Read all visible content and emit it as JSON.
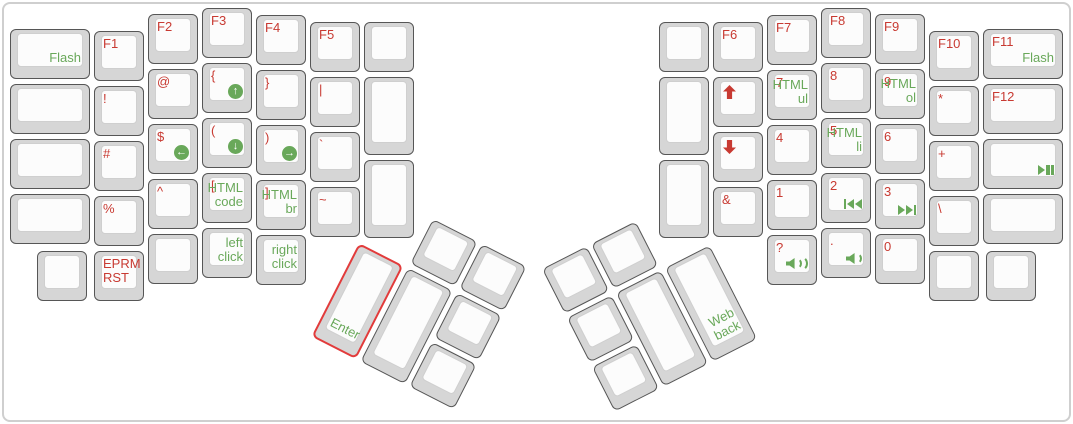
{
  "app": {
    "name": "keyboard-layout-view"
  },
  "colors": {
    "red": "#c83a32",
    "green": "#69a85a",
    "cap": "#d6d6d6",
    "ktop": "#fcfcfc",
    "kborder": "#565656",
    "ktopborder": "#cfcfcf",
    "enterline": "#e23b3b",
    "frame": "#cfcfcf"
  },
  "icons": {
    "circle-arrow-up": "↑",
    "circle-arrow-down": "↓",
    "circle-arrow-left": "←",
    "circle-arrow-right": "→"
  },
  "clusters": [
    {
      "id": "lt",
      "name": "left-thumb-cluster",
      "x": 384,
      "y": 194,
      "angle": 27
    },
    {
      "id": "rt",
      "name": "right-thumb-cluster",
      "x": 542,
      "y": 269,
      "angle": -27
    }
  ],
  "keys": [
    {
      "n": "flash",
      "x": 10,
      "y": 29,
      "w": 80,
      "br": "Flash"
    },
    {
      "n": "blank-l0r1",
      "x": 10,
      "y": 84,
      "w": 80
    },
    {
      "n": "blank-l0r2",
      "x": 10,
      "y": 139,
      "w": 80
    },
    {
      "n": "blank-l0r3",
      "x": 10,
      "y": 194,
      "w": 80
    },
    {
      "n": "f1",
      "x": 94,
      "y": 31,
      "tl": "F1"
    },
    {
      "n": "exclamation",
      "x": 94,
      "y": 86,
      "tl": "!"
    },
    {
      "n": "hash",
      "x": 94,
      "y": 141,
      "tl": "#"
    },
    {
      "n": "percent",
      "x": 94,
      "y": 196,
      "tl": "%"
    },
    {
      "n": "eprm-rst",
      "x": 94,
      "y": 251,
      "tl": "EPRM\nRST"
    },
    {
      "n": "blank-lb0",
      "x": 37,
      "y": 251
    },
    {
      "n": "f2",
      "x": 148,
      "y": 14,
      "tl": "F2"
    },
    {
      "n": "at",
      "x": 148,
      "y": 69,
      "tl": "@"
    },
    {
      "n": "dollar-mouse-left",
      "x": 148,
      "y": 124,
      "tl": "$",
      "ic": "circle-arrow-left"
    },
    {
      "n": "caret",
      "x": 148,
      "y": 179,
      "tl": "^"
    },
    {
      "n": "blank-lb2",
      "x": 148,
      "y": 234
    },
    {
      "n": "f3",
      "x": 202,
      "y": 8,
      "tl": "F3"
    },
    {
      "n": "brace-open-mouse-up",
      "x": 202,
      "y": 63,
      "tl": "{",
      "ic": "circle-arrow-up"
    },
    {
      "n": "paren-open-mouse-down",
      "x": 202,
      "y": 118,
      "tl": "(",
      "ic": "circle-arrow-down"
    },
    {
      "n": "bracket-open-html-code",
      "x": 202,
      "y": 173,
      "tl": "[",
      "br": "HTML\ncode"
    },
    {
      "n": "left-click",
      "x": 202,
      "y": 228,
      "br": "left\nclick"
    },
    {
      "n": "f4",
      "x": 256,
      "y": 15,
      "tl": "F4"
    },
    {
      "n": "brace-close",
      "x": 256,
      "y": 70,
      "tl": "}"
    },
    {
      "n": "paren-close-mouse-right",
      "x": 256,
      "y": 125,
      "tl": ")",
      "ic": "circle-arrow-right"
    },
    {
      "n": "bracket-close-html-br",
      "x": 256,
      "y": 180,
      "tl": "]",
      "br": "HTML\nbr"
    },
    {
      "n": "right-click",
      "x": 256,
      "y": 235,
      "br": "right\nclick"
    },
    {
      "n": "f5",
      "x": 310,
      "y": 22,
      "tl": "F5"
    },
    {
      "n": "pipe",
      "x": 310,
      "y": 77,
      "tl": "|"
    },
    {
      "n": "backtick",
      "x": 310,
      "y": 132,
      "tl": "`"
    },
    {
      "n": "tilde",
      "x": 310,
      "y": 187,
      "tl": "~"
    },
    {
      "n": "blank-l6r0",
      "x": 364,
      "y": 22
    },
    {
      "n": "blank-l6t1",
      "x": 364,
      "y": 77,
      "h": 78
    },
    {
      "n": "blank-l6t2",
      "x": 364,
      "y": 160,
      "h": 78
    },
    {
      "n": "blank-r6r0",
      "x": 659,
      "y": 22
    },
    {
      "n": "blank-r6t1",
      "x": 659,
      "y": 77,
      "h": 78
    },
    {
      "n": "blank-r6t2",
      "x": 659,
      "y": 160,
      "h": 78
    },
    {
      "n": "f6",
      "x": 713,
      "y": 22,
      "tl": "F6"
    },
    {
      "n": "arrow-up",
      "x": 713,
      "y": 77,
      "ic": "arrow-up",
      "icpos": "tl"
    },
    {
      "n": "arrow-down",
      "x": 713,
      "y": 132,
      "ic": "arrow-down",
      "icpos": "tl"
    },
    {
      "n": "ampersand",
      "x": 713,
      "y": 187,
      "tl": "&"
    },
    {
      "n": "f7",
      "x": 767,
      "y": 15,
      "tl": "F7"
    },
    {
      "n": "seven-html-ul",
      "x": 767,
      "y": 70,
      "tl": "7",
      "br": "HTML\nul"
    },
    {
      "n": "four",
      "x": 767,
      "y": 125,
      "tl": "4"
    },
    {
      "n": "one",
      "x": 767,
      "y": 180,
      "tl": "1"
    },
    {
      "n": "question-volume-up",
      "x": 767,
      "y": 235,
      "tl": "?",
      "ic": "volume-up"
    },
    {
      "n": "f8",
      "x": 821,
      "y": 8,
      "tl": "F8"
    },
    {
      "n": "eight",
      "x": 821,
      "y": 63,
      "tl": "8"
    },
    {
      "n": "five-html-li",
      "x": 821,
      "y": 118,
      "tl": "5",
      "br": "HTML\nli"
    },
    {
      "n": "two-prev-track",
      "x": 821,
      "y": 173,
      "tl": "2",
      "ic": "prev-track"
    },
    {
      "n": "period-volume-down",
      "x": 821,
      "y": 228,
      "tl": ".",
      "ic": "volume-down"
    },
    {
      "n": "f9",
      "x": 875,
      "y": 14,
      "tl": "F9"
    },
    {
      "n": "nine-html-ol",
      "x": 875,
      "y": 69,
      "tl": "9",
      "br": "HTML\nol"
    },
    {
      "n": "six",
      "x": 875,
      "y": 124,
      "tl": "6"
    },
    {
      "n": "three-next-track",
      "x": 875,
      "y": 179,
      "tl": "3",
      "ic": "next-track"
    },
    {
      "n": "zero",
      "x": 875,
      "y": 234,
      "tl": "0"
    },
    {
      "n": "f10",
      "x": 929,
      "y": 31,
      "tl": "F10"
    },
    {
      "n": "asterisk",
      "x": 929,
      "y": 86,
      "tl": "*"
    },
    {
      "n": "plus",
      "x": 929,
      "y": 141,
      "tl": "+"
    },
    {
      "n": "backslash",
      "x": 929,
      "y": 196,
      "tl": "\\"
    },
    {
      "n": "blank-rb3",
      "x": 929,
      "y": 251
    },
    {
      "n": "f11-flash",
      "x": 983,
      "y": 29,
      "w": 80,
      "tl": "F11",
      "br": "Flash"
    },
    {
      "n": "f12",
      "x": 983,
      "y": 84,
      "w": 80,
      "tl": "F12"
    },
    {
      "n": "play-pause",
      "x": 983,
      "y": 139,
      "w": 80,
      "ic": "play-pause"
    },
    {
      "n": "blank-r0r3",
      "x": 983,
      "y": 194,
      "w": 80
    },
    {
      "n": "blank-rb4",
      "x": 986,
      "y": 251
    },
    {
      "n": "thumb-blank-1",
      "cl": "lt",
      "x": 55,
      "y": 0
    },
    {
      "n": "thumb-blank-2",
      "cl": "lt",
      "x": 110,
      "y": 0
    },
    {
      "n": "enter",
      "cl": "lt",
      "x": 0,
      "y": 55,
      "h": 105,
      "outline": true,
      "bl": "Enter"
    },
    {
      "n": "thumb-blank-3",
      "cl": "lt",
      "x": 55,
      "y": 55,
      "h": 105
    },
    {
      "n": "thumb-blank-4",
      "cl": "lt",
      "x": 110,
      "y": 55
    },
    {
      "n": "thumb-blank-5",
      "cl": "lt",
      "x": 110,
      "y": 110
    },
    {
      "n": "thumb-blank-6",
      "cl": "rt",
      "x": 0,
      "y": 0
    },
    {
      "n": "thumb-blank-7",
      "cl": "rt",
      "x": 55,
      "y": 0
    },
    {
      "n": "thumb-blank-8",
      "cl": "rt",
      "x": 0,
      "y": 55
    },
    {
      "n": "thumb-blank-9",
      "cl": "rt",
      "x": 55,
      "y": 55,
      "h": 105
    },
    {
      "n": "web-back",
      "cl": "rt",
      "x": 110,
      "y": 55,
      "h": 105,
      "br": "Web\nback"
    },
    {
      "n": "thumb-blank-10",
      "cl": "rt",
      "x": 0,
      "y": 110
    }
  ]
}
